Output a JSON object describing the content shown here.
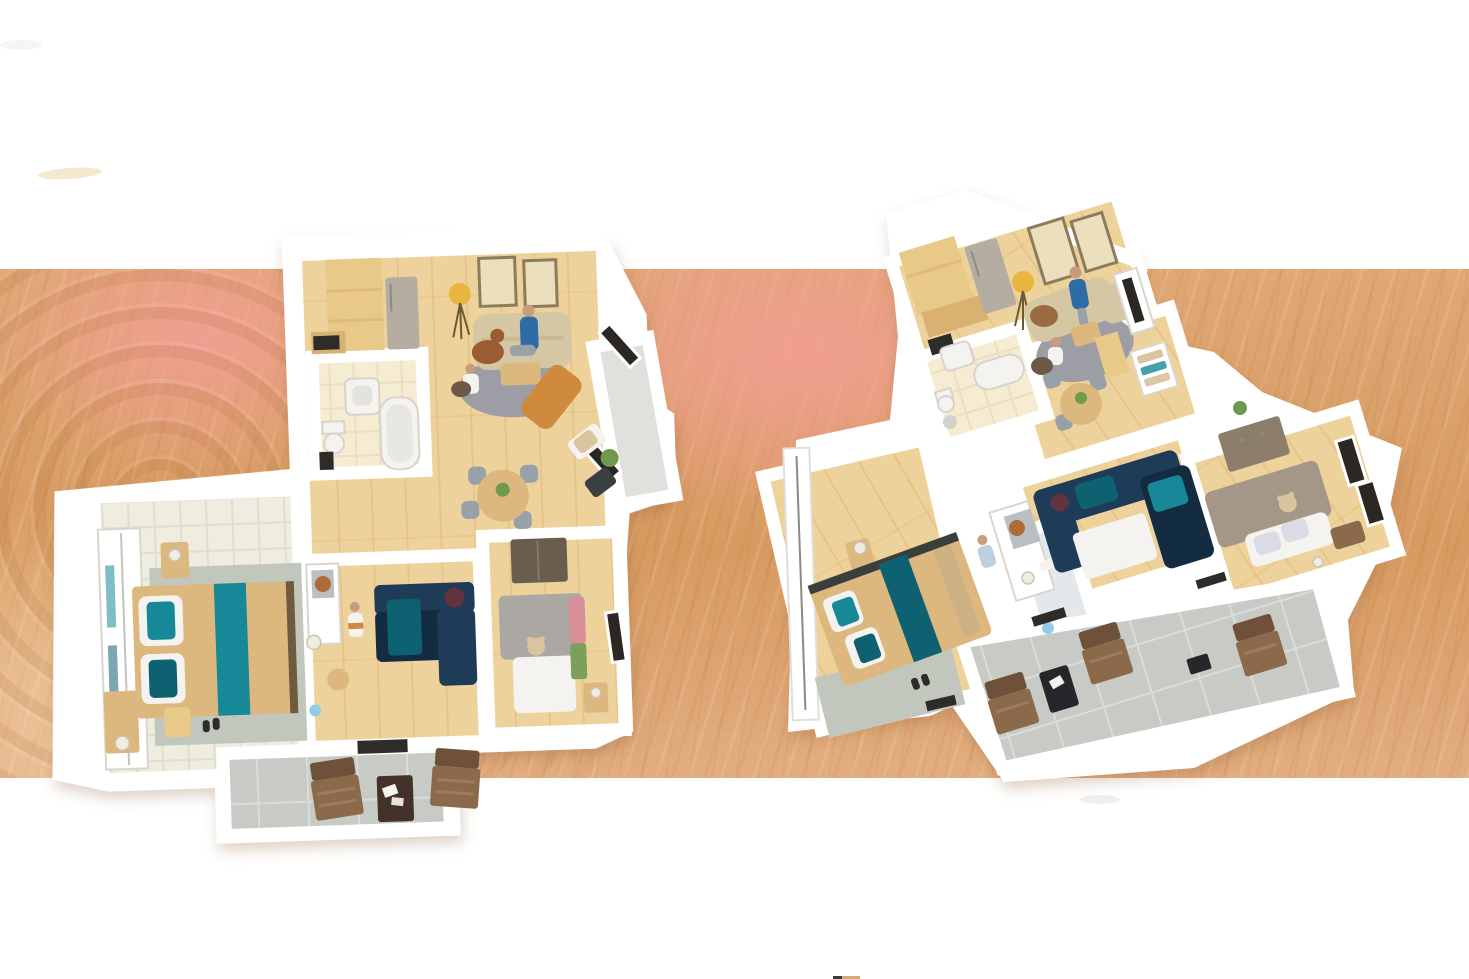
{
  "image": {
    "kind": "3d-floor-plan-rendering",
    "description": "Two photorealistic 3D apartment floor plans viewed from above, placed on a sandy wood-grain background with a salmon tint band; white bands at top and bottom; no visible text, labels or UI controls.",
    "plans_count": 2
  },
  "colors": {
    "background": "#ffffff",
    "sand_base": "#e0a876",
    "sand_deep": "#d89a60",
    "sand_light": "#e2ad80",
    "blush": "#f2a093",
    "wall": "#ffffff",
    "wall_shade": "#e6e1d9",
    "floor_wood": "#eed29b",
    "floor_wood_dark": "#dfb87c",
    "floor_pale": "#efece0",
    "floor_pale_line": "#e1ddcf",
    "tile_bath": "#f6ecd2",
    "tile_bath_line": "#eadfc2",
    "tile_terrace": "#c8cac6",
    "tile_terrace_line": "#dadcd8",
    "entry_gray": "#e0e1dd",
    "hall_blue": "#e4e8eb",
    "teal": "#178898",
    "teal_deep": "#0e6170",
    "navy": "#1e3c58",
    "navy_deep": "#142c42",
    "maroon": "#63333f",
    "sofa_beige": "#d6c7a4",
    "rug_gray": "#9c9da5",
    "wood_furniture": "#dcb87e",
    "wood_cabinet": "#e8c987",
    "wood_cabinet_dark": "#d9b272",
    "appliance": "#b5ada1",
    "dark": "#2e2c28",
    "frame": "#8c7c5c",
    "art": "#ecdfbd",
    "lamp_yellow": "#e8b63e",
    "lamp_shade": "#f0ece2",
    "chair_brown": "#8a6a4b",
    "chair_brown_dark": "#6e5138",
    "table_brown": "#44322a",
    "table_black": "#26272b",
    "skin": "#c99c7d",
    "shirt_blue": "#2d6ca6",
    "pants": "#98a0a8",
    "gray_bed": "#aba7a3",
    "white_soft": "#f4f3f0",
    "accent_pink": "#d98f99",
    "accent_green": "#7aa05c",
    "accent_orange": "#d08a3e",
    "teddy": "#d9c49d",
    "dresser_taupe": "#8d7e6b",
    "cover_taupe": "#a59788",
    "pillow_lavender": "#dbdbe6",
    "plant_green": "#6f9a4e",
    "window_dark": "#2b2824",
    "mat_gray": "#c2c7bd",
    "wardrobe_seam": "#8a8a86",
    "dog_brown": "#9b5c33",
    "toy_blue": "#92cce8"
  },
  "scene": {
    "plan_left": {
      "rooms": [
        "kitchen",
        "living-dining-room",
        "bathroom",
        "master-bedroom",
        "kids-room",
        "bedroom",
        "entry-nook",
        "terrace"
      ],
      "figures": [
        "person-on-sofa",
        "person-kneeling",
        "child-in-kids-room",
        "dog"
      ],
      "notable_items": [
        "fridge",
        "wood-cabinets",
        "two-wall-pictures",
        "yellow-tripod-lamp",
        "round-gray-rug",
        "bathtub",
        "toilet",
        "sink",
        "teal-double-bed",
        "navy-kids-sofa",
        "gray-bed-with-teddy",
        "two-terrace-chairs",
        "terrace-table"
      ]
    },
    "plan_right": {
      "rooms": [
        "kitchen",
        "living-room",
        "bathroom",
        "dining-nook",
        "hallway",
        "master-bedroom",
        "media-room",
        "bedroom-lounge",
        "balcony"
      ],
      "figures": [
        "person-standing",
        "child-sitting",
        "child-near-hall"
      ],
      "notable_items": [
        "fridge",
        "wood-cabinets",
        "two-wall-pictures",
        "yellow-tripod-lamp",
        "curved-beige-sofa",
        "round-gray-rug",
        "bathtub",
        "toilet",
        "sink",
        "teal-double-bed",
        "navy-media-sectional",
        "taupe-bed-with-teddy",
        "dresser",
        "three-balcony-chairs",
        "black-balcony-table"
      ]
    },
    "background": {
      "bands": [
        "white-top",
        "sand-wood-middle",
        "white-bottom"
      ],
      "tints": [
        "salmon-blush-left",
        "salmon-blush-center"
      ],
      "artifacts": [
        "faint-beige-curve-top-left",
        "faint-gray-smudge-top-left",
        "gray-smudge-bottom-right-of-right-plan",
        "dark-tan-sliver-bottom-edge"
      ]
    }
  }
}
